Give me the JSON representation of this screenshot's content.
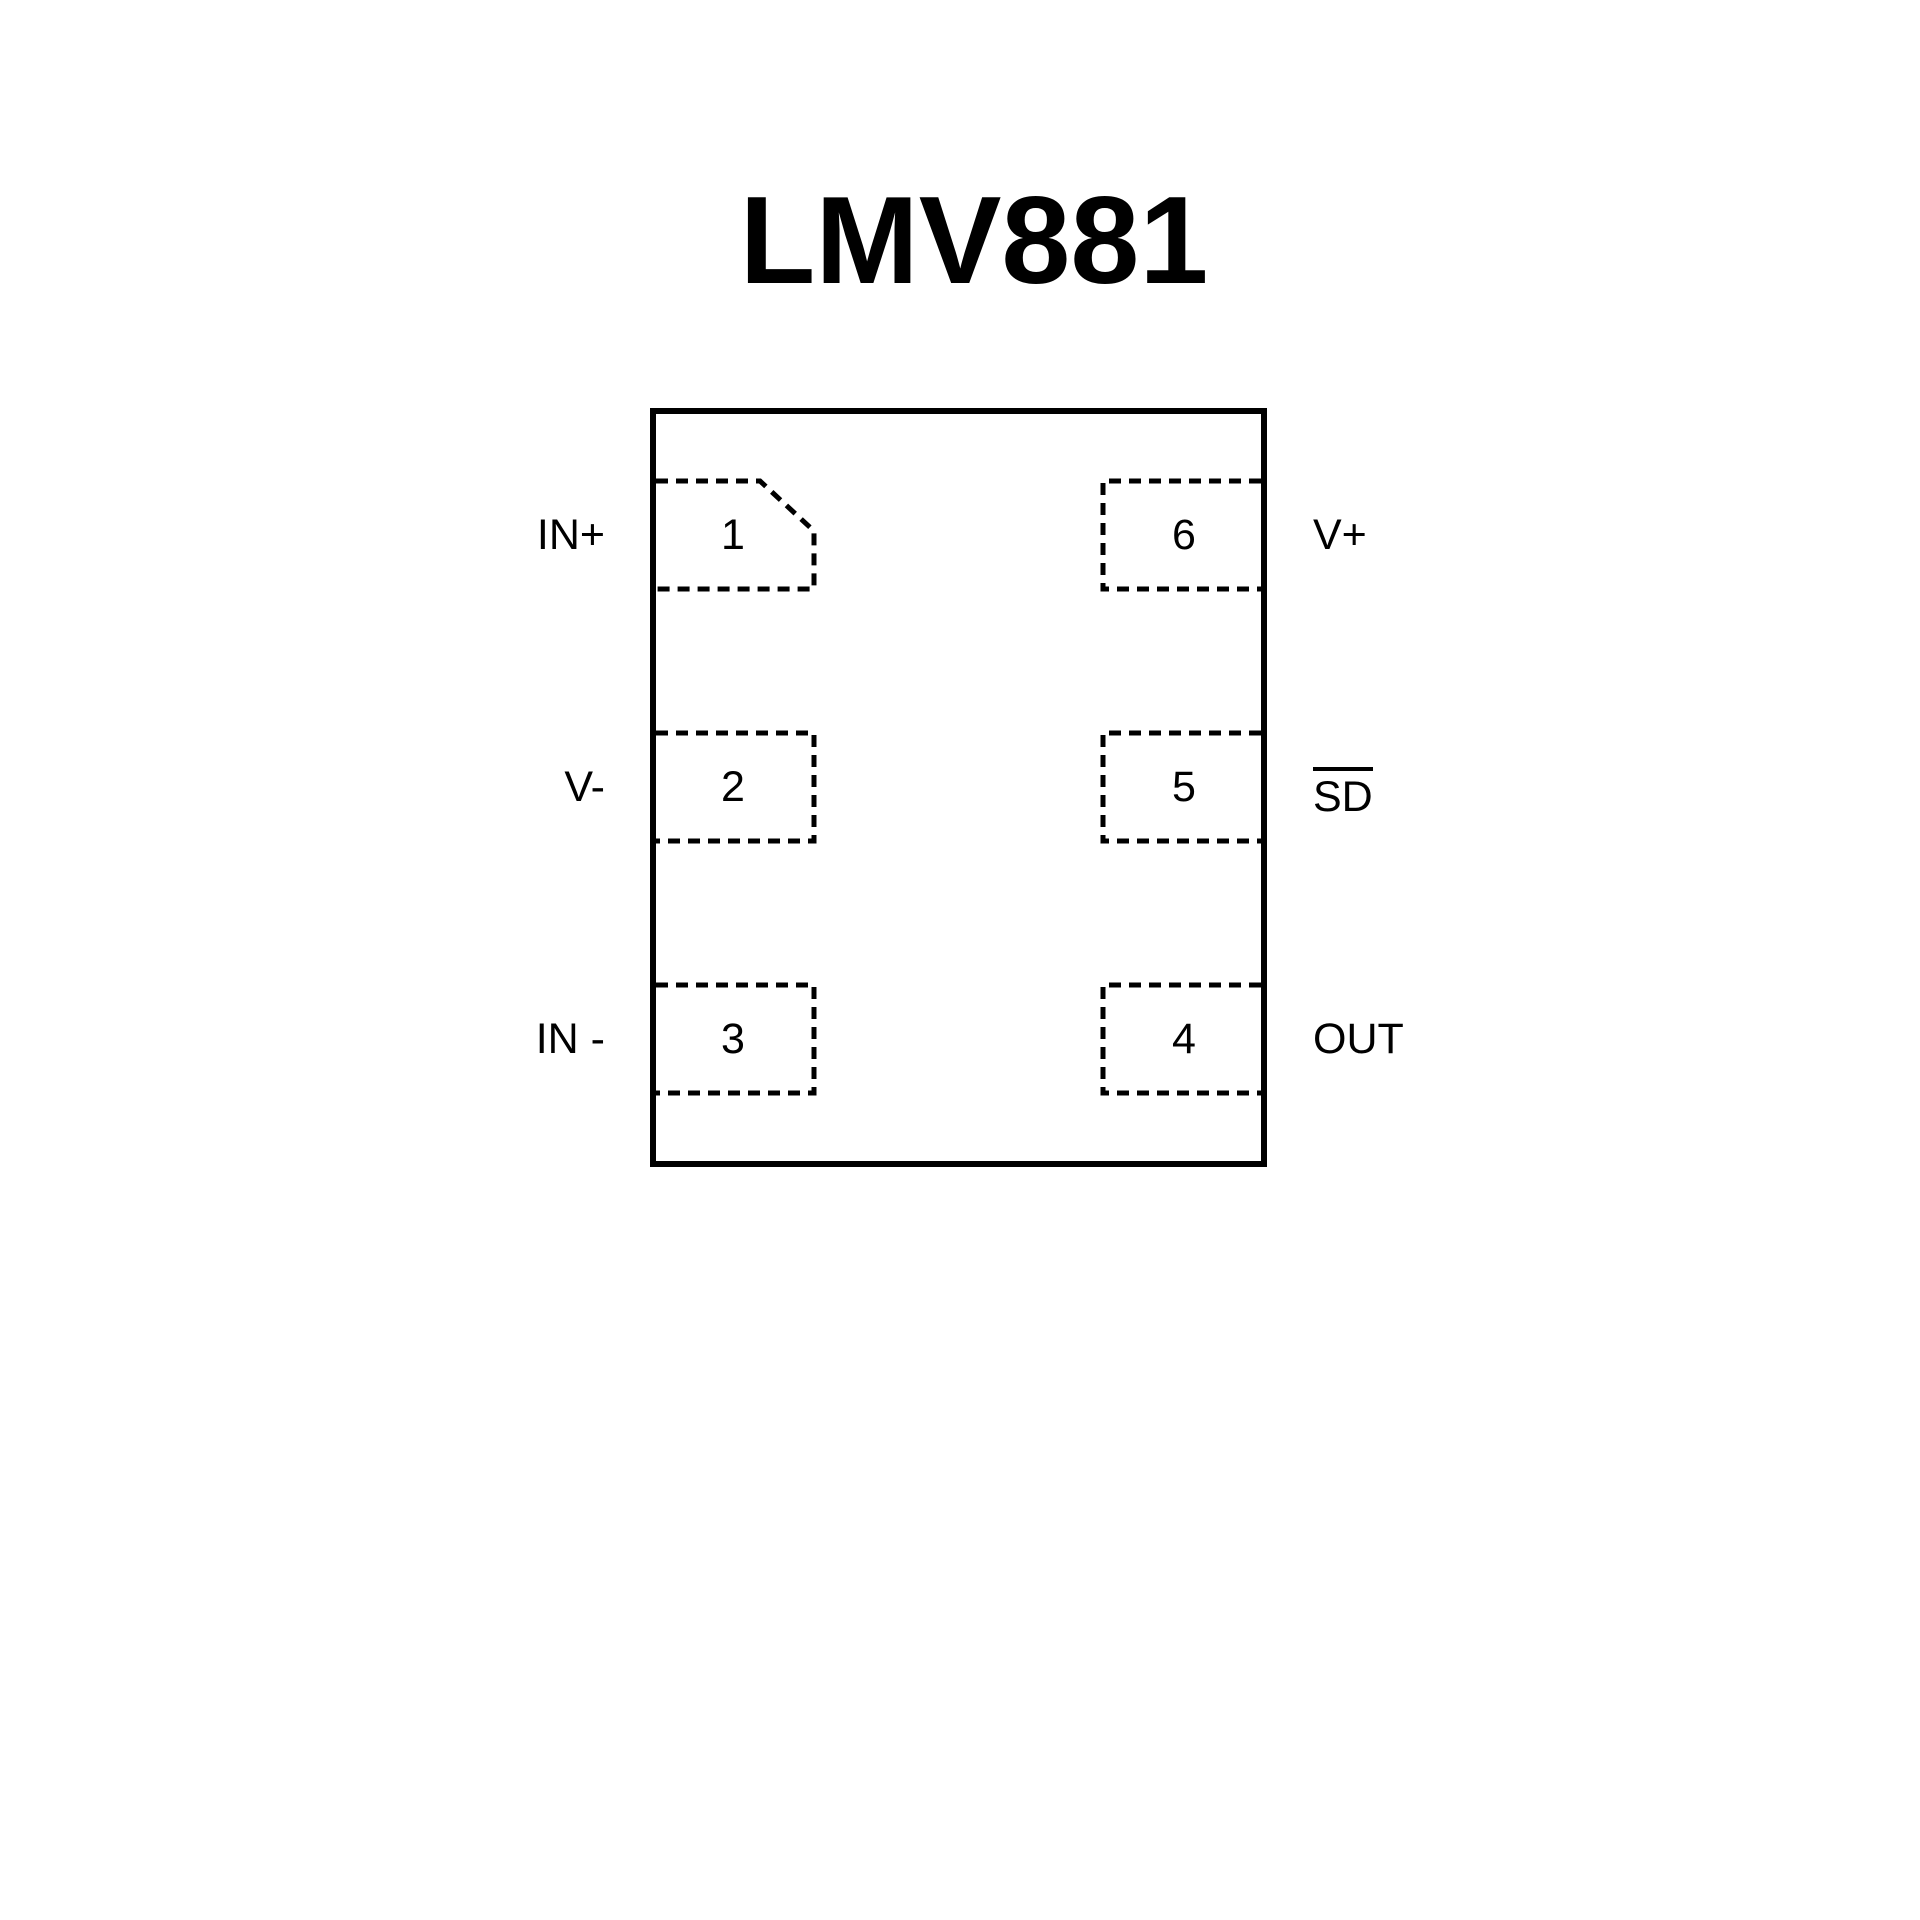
{
  "title": "LMV881",
  "diagram": {
    "type": "ic-pinout",
    "colors": {
      "line": "#000000",
      "text": "#000000",
      "background": "#ffffff"
    },
    "pins": [
      {
        "number": "1",
        "label": "IN+",
        "side": "left",
        "row": 1,
        "pin1_marker": true
      },
      {
        "number": "2",
        "label": "V-",
        "side": "left",
        "row": 2
      },
      {
        "number": "3",
        "label": "IN -",
        "side": "left",
        "row": 3
      },
      {
        "number": "4",
        "label": "OUT",
        "side": "right",
        "row": 3
      },
      {
        "number": "5",
        "label": "SD",
        "side": "right",
        "row": 2,
        "overline": true
      },
      {
        "number": "6",
        "label": "V+",
        "side": "right",
        "row": 1
      }
    ]
  }
}
